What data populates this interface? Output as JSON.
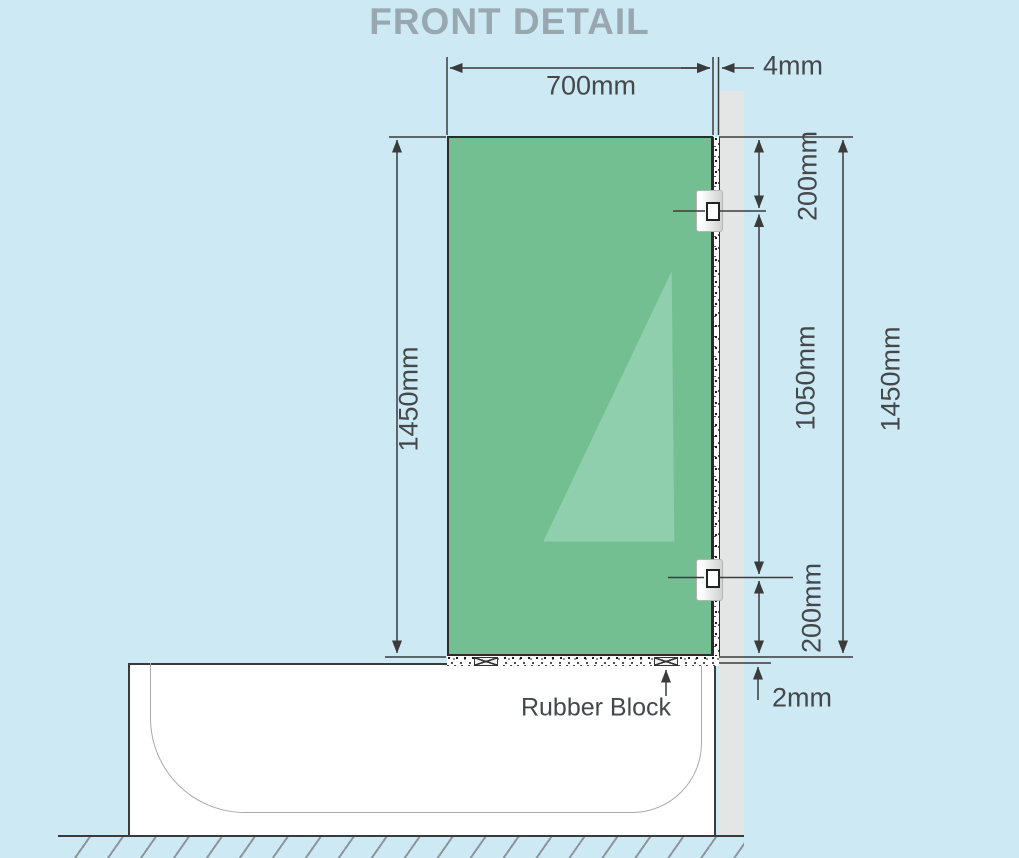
{
  "title": "FRONT DETAIL",
  "dimensions": {
    "glass_width": "700mm",
    "wall_gap": "4mm",
    "glass_height_left": "1450mm",
    "top_bracket_offset": "200mm",
    "between_brackets": "1050mm",
    "glass_height_right": "1450mm",
    "bottom_bracket_offset": "200mm",
    "bottom_gap": "2mm"
  },
  "labels": {
    "rubber_block": "Rubber Block"
  },
  "colors": {
    "background": "#cdeaf4",
    "glass": "#73bf92",
    "glass_highlight": "#8fcfad",
    "wall": "#e4e6e6",
    "line": "#3b3b3b",
    "dimension_text": "#45484a",
    "title_text": "#98a7b0"
  }
}
